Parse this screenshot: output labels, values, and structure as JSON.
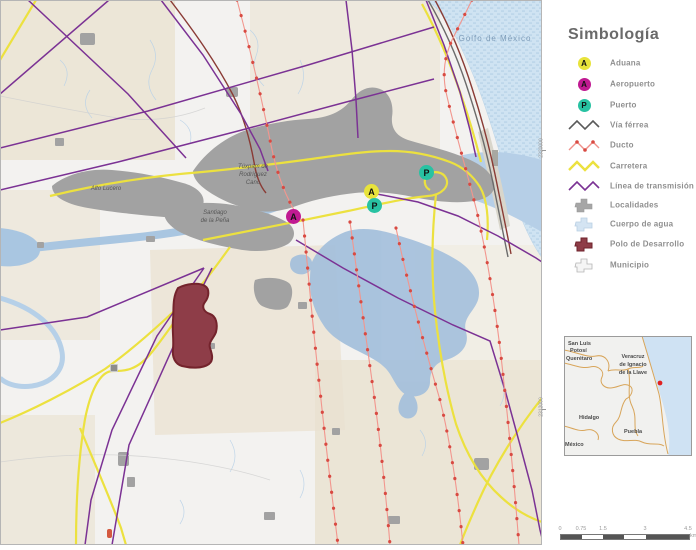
{
  "map": {
    "labels": {
      "gulf": "Golfo de México",
      "city_line1": "Túxpam de",
      "city_line2": "Rodríguez",
      "city_line3": "Cano",
      "alto_lucero": "Alto Lucero",
      "santiago_line1": "Santiago",
      "santiago_line2": "de la Peña",
      "grid_top": "2320000",
      "grid_bottom": "2312000"
    },
    "markers": {
      "aduana_letter": "A",
      "aeropuerto_letter": "A",
      "puerto_letter": "P"
    }
  },
  "legend": {
    "title": "Simbología",
    "items": [
      {
        "label": "Aduana",
        "type": "point",
        "letter": "A",
        "color": "#e8e33b"
      },
      {
        "label": "Aeropuerto",
        "type": "point",
        "letter": "A",
        "color": "#c01a92"
      },
      {
        "label": "Puerto",
        "type": "point",
        "letter": "P",
        "color": "#28c2a2"
      },
      {
        "label": "Vía férrea",
        "type": "line",
        "color": "#5a5a5a"
      },
      {
        "label": "Ducto",
        "type": "line-dots",
        "color": "#f0918b"
      },
      {
        "label": "Carretera",
        "type": "line",
        "color": "#ece13f"
      },
      {
        "label": "Línea de transmisión",
        "type": "line",
        "color": "#7b3294"
      },
      {
        "label": "Localidades",
        "type": "polygon",
        "color": "#a6a6a6"
      },
      {
        "label": "Cuerpo de agua",
        "type": "polygon",
        "color": "#cfe2f1"
      },
      {
        "label": "Polo de Desarrollo",
        "type": "polygon",
        "color": "#8e3d48"
      },
      {
        "label": "Municipio",
        "type": "polygon-outline",
        "color": "#f5f5f5"
      }
    ]
  },
  "inset": {
    "labels": {
      "san_luis_1": "San Luis",
      "san_luis_2": "Potosí",
      "queretaro": "Querétaro",
      "veracruz_1": "Veracruz",
      "veracruz_2": "de Ignacio",
      "veracruz_3": "de la Llave",
      "hidalgo": "Hidalgo",
      "puebla": "Puebla",
      "mexico": "México"
    }
  },
  "scalebar": {
    "ticks": [
      "0",
      "0.75",
      "1.5",
      "3",
      "4.5"
    ],
    "unit": "km"
  },
  "colors": {
    "water": "#cfe3f2",
    "river": "#a9c6e1",
    "urban": "#a2a2a2",
    "beige_land": "#e9e1cf",
    "polo_fill": "#8e3d48",
    "polo_stroke": "#74232c",
    "carretera": "#ece13f",
    "transmission": "#7b3294",
    "ducto_line": "#f2968e",
    "ducto_dot": "#d84a42",
    "railroad": "#6b6b6b",
    "inset_border": "#d8a55a",
    "inset_dot": "#e02020"
  }
}
